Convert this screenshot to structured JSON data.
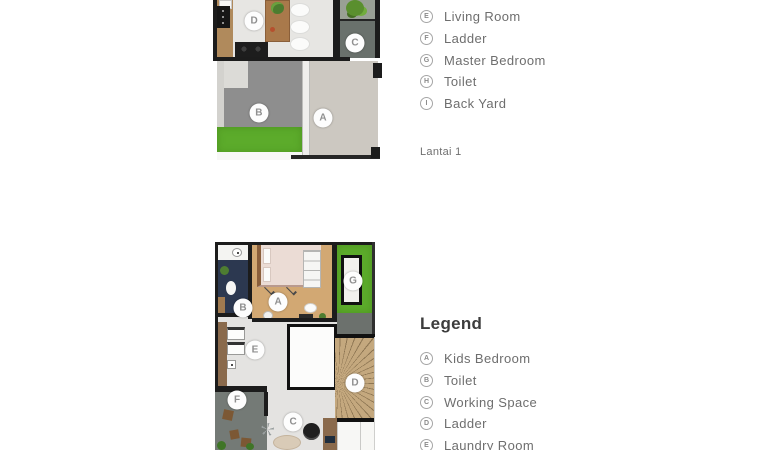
{
  "page": {
    "background": "#ffffff"
  },
  "palette": {
    "wall": "#1c1c1c",
    "grass": "#5cab2b",
    "wood_floor": "#d2a873",
    "kitchen_wood": "#b08a5c",
    "toilet_tile": "#2c3850",
    "pavement": "#8e8e8e",
    "concrete": "#ccc8c1",
    "stairs": "#c4a87e",
    "terrace_gray": "#6c716d",
    "text_gray": "#6e6e6e",
    "heading_gray": "#3c3c3c"
  },
  "floor1": {
    "caption": "Lantai 1",
    "markers": [
      {
        "letter": "D",
        "x": 24.6,
        "y": 13.1
      },
      {
        "letter": "C",
        "x": 85.0,
        "y": 26.9
      },
      {
        "letter": "B",
        "x": 27.5,
        "y": 70.6
      },
      {
        "letter": "A",
        "x": 65.9,
        "y": 73.8
      }
    ],
    "legend": [
      {
        "letter": "E",
        "label": "Living Room"
      },
      {
        "letter": "F",
        "label": "Ladder"
      },
      {
        "letter": "G",
        "label": "Master Bedroom"
      },
      {
        "letter": "H",
        "label": "Toilet"
      },
      {
        "letter": "I",
        "label": "Back Yard"
      }
    ]
  },
  "floor2": {
    "legend_title": "Legend",
    "markers": [
      {
        "letter": "B",
        "x": 17.2,
        "y": 31.7
      },
      {
        "letter": "A",
        "x": 38.7,
        "y": 28.8
      },
      {
        "letter": "G",
        "x": 84.7,
        "y": 18.8
      },
      {
        "letter": "E",
        "x": 24.5,
        "y": 51.9
      },
      {
        "letter": "D",
        "x": 85.9,
        "y": 67.8
      },
      {
        "letter": "F",
        "x": 13.5,
        "y": 76.0
      },
      {
        "letter": "C",
        "x": 47.9,
        "y": 86.5
      }
    ],
    "legend": [
      {
        "letter": "A",
        "label": "Kids Bedroom"
      },
      {
        "letter": "B",
        "label": "Toilet"
      },
      {
        "letter": "C",
        "label": "Working Space"
      },
      {
        "letter": "D",
        "label": "Ladder"
      },
      {
        "letter": "E",
        "label": "Laundry Room"
      }
    ]
  }
}
